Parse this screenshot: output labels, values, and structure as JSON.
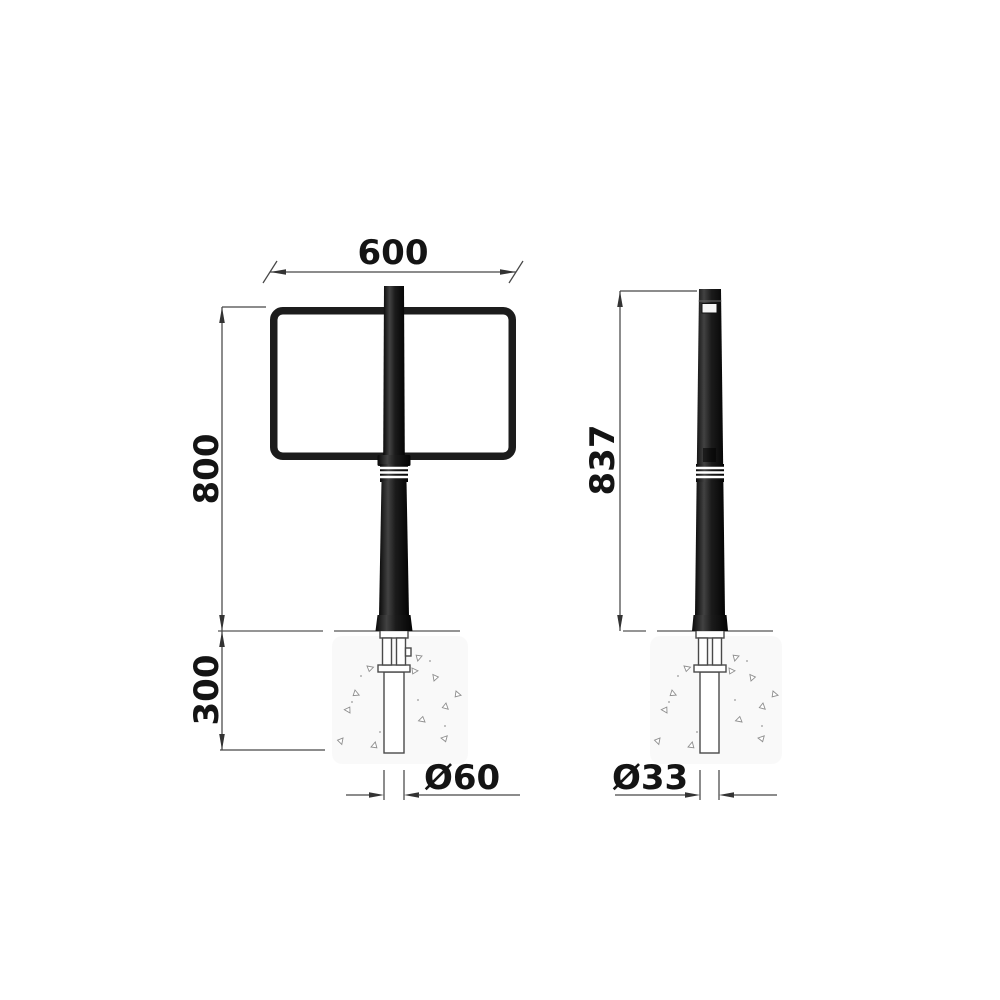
{
  "drawing": {
    "kind": "technical-dimension-drawing",
    "subject": "sign-post-bollard",
    "views": {
      "front": {
        "dims": {
          "sign_width": "600",
          "height_above_ground": "800",
          "embed_depth": "300",
          "post_diameter": "Ø60"
        }
      },
      "side": {
        "dims": {
          "height_above_ground": "837",
          "post_diameter": "Ø33"
        }
      }
    },
    "colors": {
      "background": "#ffffff",
      "dimension_line": "#474747",
      "dimension_text": "#141414",
      "post_black": "#141414",
      "post_highlight": "#404040",
      "hardware_outline": "#4a4a4a",
      "concrete_speckle": "#8f8f8f"
    }
  }
}
